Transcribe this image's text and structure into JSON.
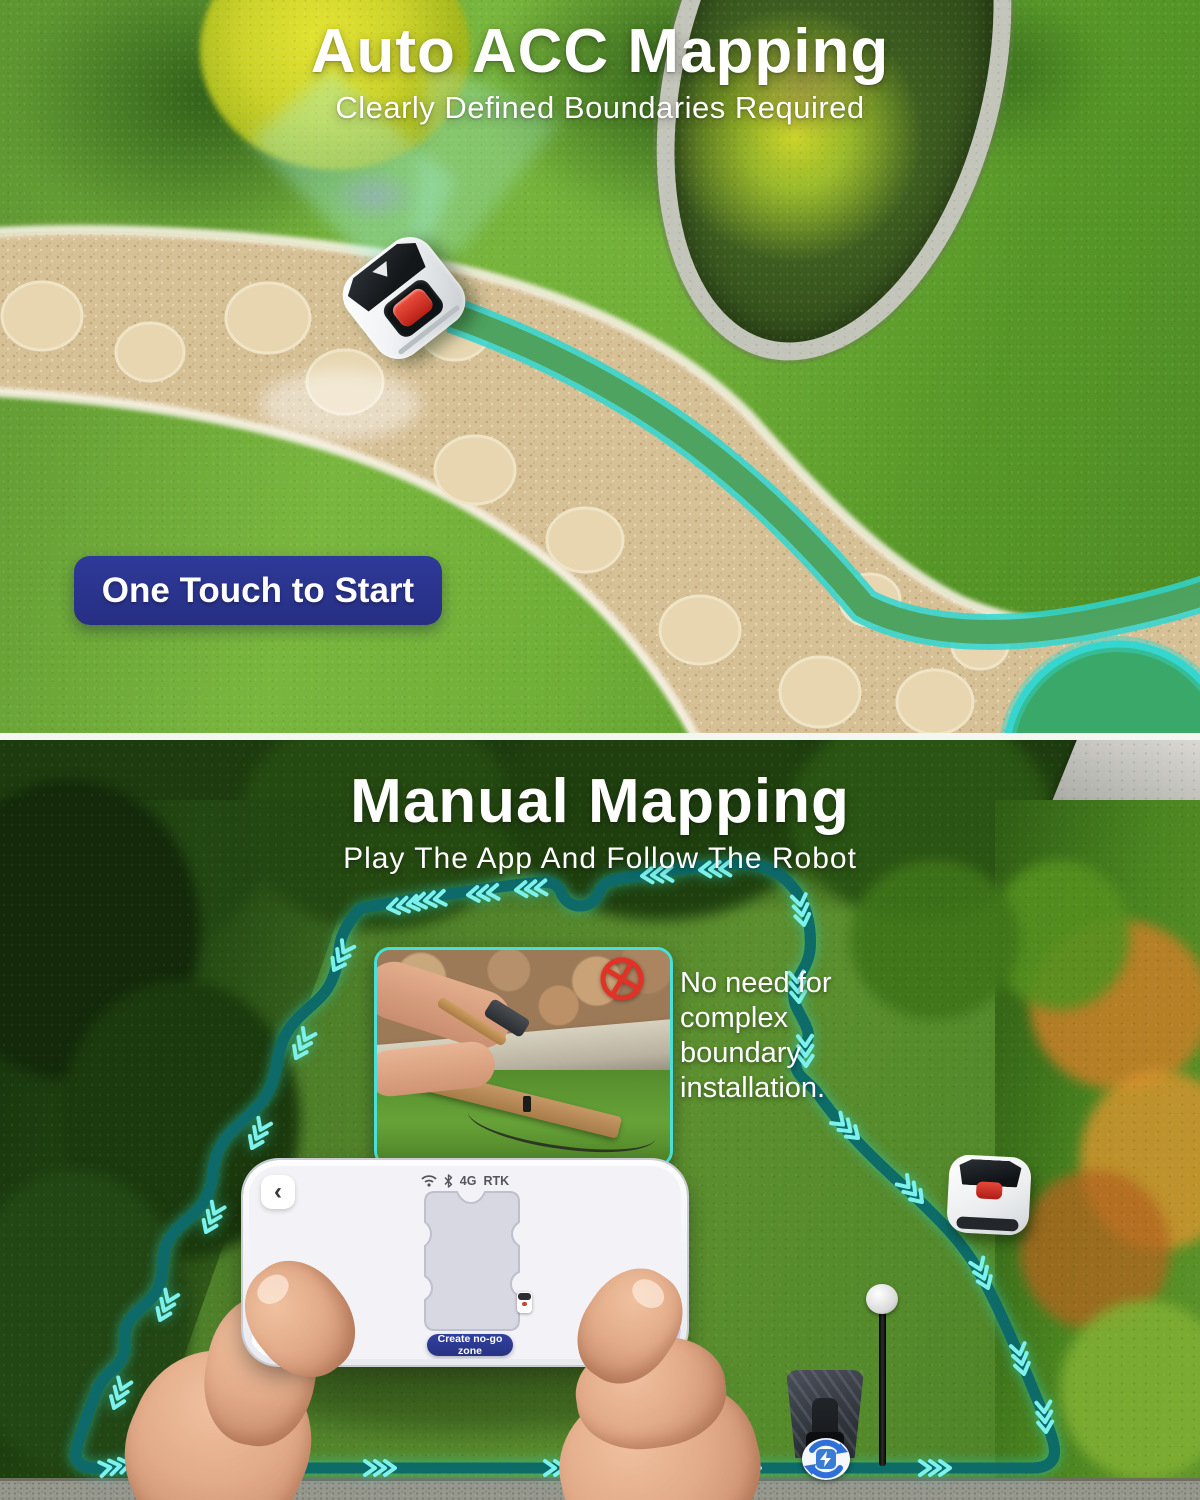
{
  "auto_section": {
    "title": "Auto ACC Mapping",
    "subtitle": "Clearly Defined Boundaries Required",
    "start_button_label": "One Touch to Start"
  },
  "manual_section": {
    "title": "Manual Mapping",
    "subtitle": "Play The App And Follow The Robot",
    "callout_lines": [
      "No need for",
      "complex",
      "boundary",
      "installation."
    ]
  },
  "phone_app": {
    "back_glyph": "‹",
    "status_network": "4G",
    "status_rtk": "RTK",
    "create_no_go_label": "Create no-go zone"
  },
  "colors": {
    "accent_teal": "#35d6cf",
    "navy_button": "#2b3590",
    "alert_red": "#e23125",
    "joystick_blue": "#333f9e"
  },
  "icons": {
    "wifi": "wifi-icon",
    "bluetooth": "bluetooth-icon",
    "back": "back-chevron-icon",
    "no_entry": "no-entry-icon",
    "charge_sync": "charge-sync-icon",
    "robot_marker": "robot-marker-icon",
    "direction_chevrons": "boundary-direction-chevrons"
  }
}
